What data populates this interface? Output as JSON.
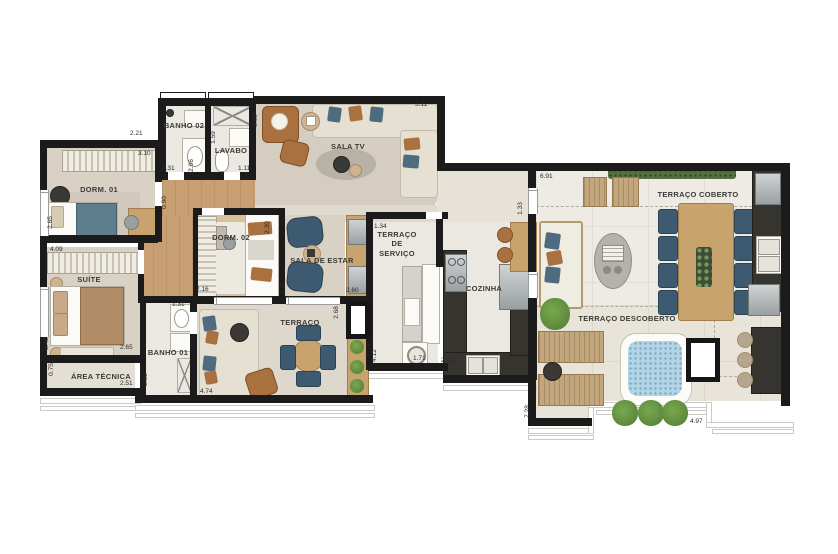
{
  "rooms": {
    "dorm01": "DORM. 01",
    "suite": "SUÍTE",
    "banho02": "BANHO 02",
    "lavabo": "LAVABO",
    "sala_tv": "SALA TV",
    "dorm02": "DORM. 02",
    "sala_estar": "SALA DE ESTAR",
    "terraco_servico": "TERRAÇO DE SERVIÇO",
    "cozinha": "COZINHA",
    "banho01": "BANHO 01",
    "area_tecnica": "ÁREA TÉCNICA",
    "terraco": "TERRAÇO",
    "terraco_coberto": "TERRAÇO COBERTO",
    "terraco_descoberto": "TERRAÇO DESCOBERTO"
  },
  "dims": {
    "d221": "2.21",
    "d310": "3.10",
    "d159": "1.59",
    "d206": "2.06",
    "d131a": "1.31",
    "d111": "1.11",
    "d309": "3.09",
    "d511": "5.11",
    "d090": "0.90",
    "d265a": "2.65",
    "d409": "4.09",
    "d342": "3.42",
    "d265b": "2.65",
    "d075": "0.75",
    "d251": "2.51",
    "d131b": "1.31",
    "d252": "2.52",
    "d216": "2.16",
    "d230": "2.30",
    "d502": "5.02",
    "d260": "2.60",
    "d268": "2.68",
    "d474": "4.74",
    "d412": "4.12",
    "d171": "1.71",
    "d245": "2.45",
    "d134": "1.34",
    "d133": "1.33",
    "d691": "6.91",
    "d728": "7.28",
    "d497": "4.97"
  },
  "palette": {
    "wall": "#1b1b1b",
    "tile": "#eae8e1",
    "carpet": "#d8d1c4",
    "wood": "#c89f72",
    "chair_blue": "#3d5a70",
    "leather_brown": "#a9713f",
    "water_blue": "#b3d4e4",
    "plant_green": "#5d8a48",
    "counter_dark": "#35342f"
  }
}
